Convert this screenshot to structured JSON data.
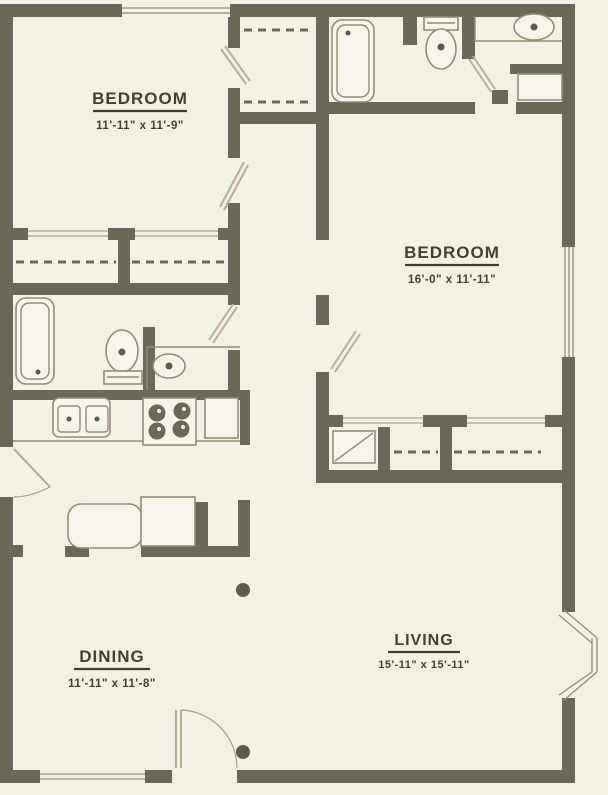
{
  "plan": {
    "title": "apartment-floor-plan",
    "rooms": [
      {
        "name": "BEDROOM",
        "dims": "11'-11\" x 11'-9\""
      },
      {
        "name": "BEDROOM",
        "dims": "16'-0\" x 11'-11\""
      },
      {
        "name": "DINING",
        "dims": "11'-11\" x 11'-8\""
      },
      {
        "name": "LIVING",
        "dims": "15'-11\" x 15'-11\""
      }
    ],
    "colors": {
      "wall": "#6c6857",
      "paper": "#f3f0e6",
      "fixture_line": "#958c77",
      "door_leaf": "#b9ae93",
      "label_text": "#453f30"
    }
  }
}
